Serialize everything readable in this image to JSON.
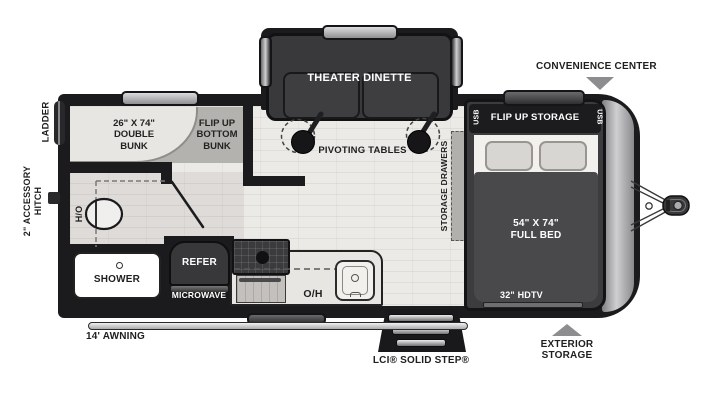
{
  "diagram_type": "travel trailer floor plan",
  "colors": {
    "outline": "#1b1b1d",
    "floor": "#eceae7",
    "furniture_dark": "#39393b",
    "front_cap_gray": "#a9a9ab",
    "callout_arrow_gray": "#8d8d8f",
    "label_text": "#1f1f1f"
  },
  "exterior": {
    "ladder": "LADDER",
    "accessory_hitch_line1": "2\" ACCESSORY",
    "accessory_hitch_line2": "HITCH",
    "awning": "14' AWNING",
    "solid_step": "LCI® SOLID STEP®",
    "exterior_storage_line1": "EXTERIOR",
    "exterior_storage_line2": "STORAGE",
    "convenience_center": "CONVENIENCE CENTER"
  },
  "rooms": {
    "bunk": {
      "double_bunk_line1": "26\" X 74\"",
      "double_bunk_line2": "DOUBLE",
      "double_bunk_line3": "BUNK",
      "flip_bunk_line1": "FLIP UP",
      "flip_bunk_line2": "BOTTOM",
      "flip_bunk_line3": "BUNK"
    },
    "living": {
      "sofa": "THEATER DINETTE",
      "tables": "PIVOTING TABLES"
    },
    "bedroom": {
      "headboard": "FLIP UP STORAGE",
      "usb_left": "USB",
      "usb_right": "USB",
      "drawers": "STORAGE DRAWERS",
      "bed_line1": "54\" X 74\"",
      "bed_line2": "FULL BED",
      "tv": "32\" HDTV"
    },
    "bath": {
      "water_heater": "H/O",
      "shower": "SHOWER"
    },
    "kitchen": {
      "refrigerator": "REFER",
      "microwave": "MICROWAVE",
      "overhead": "O/H"
    }
  }
}
